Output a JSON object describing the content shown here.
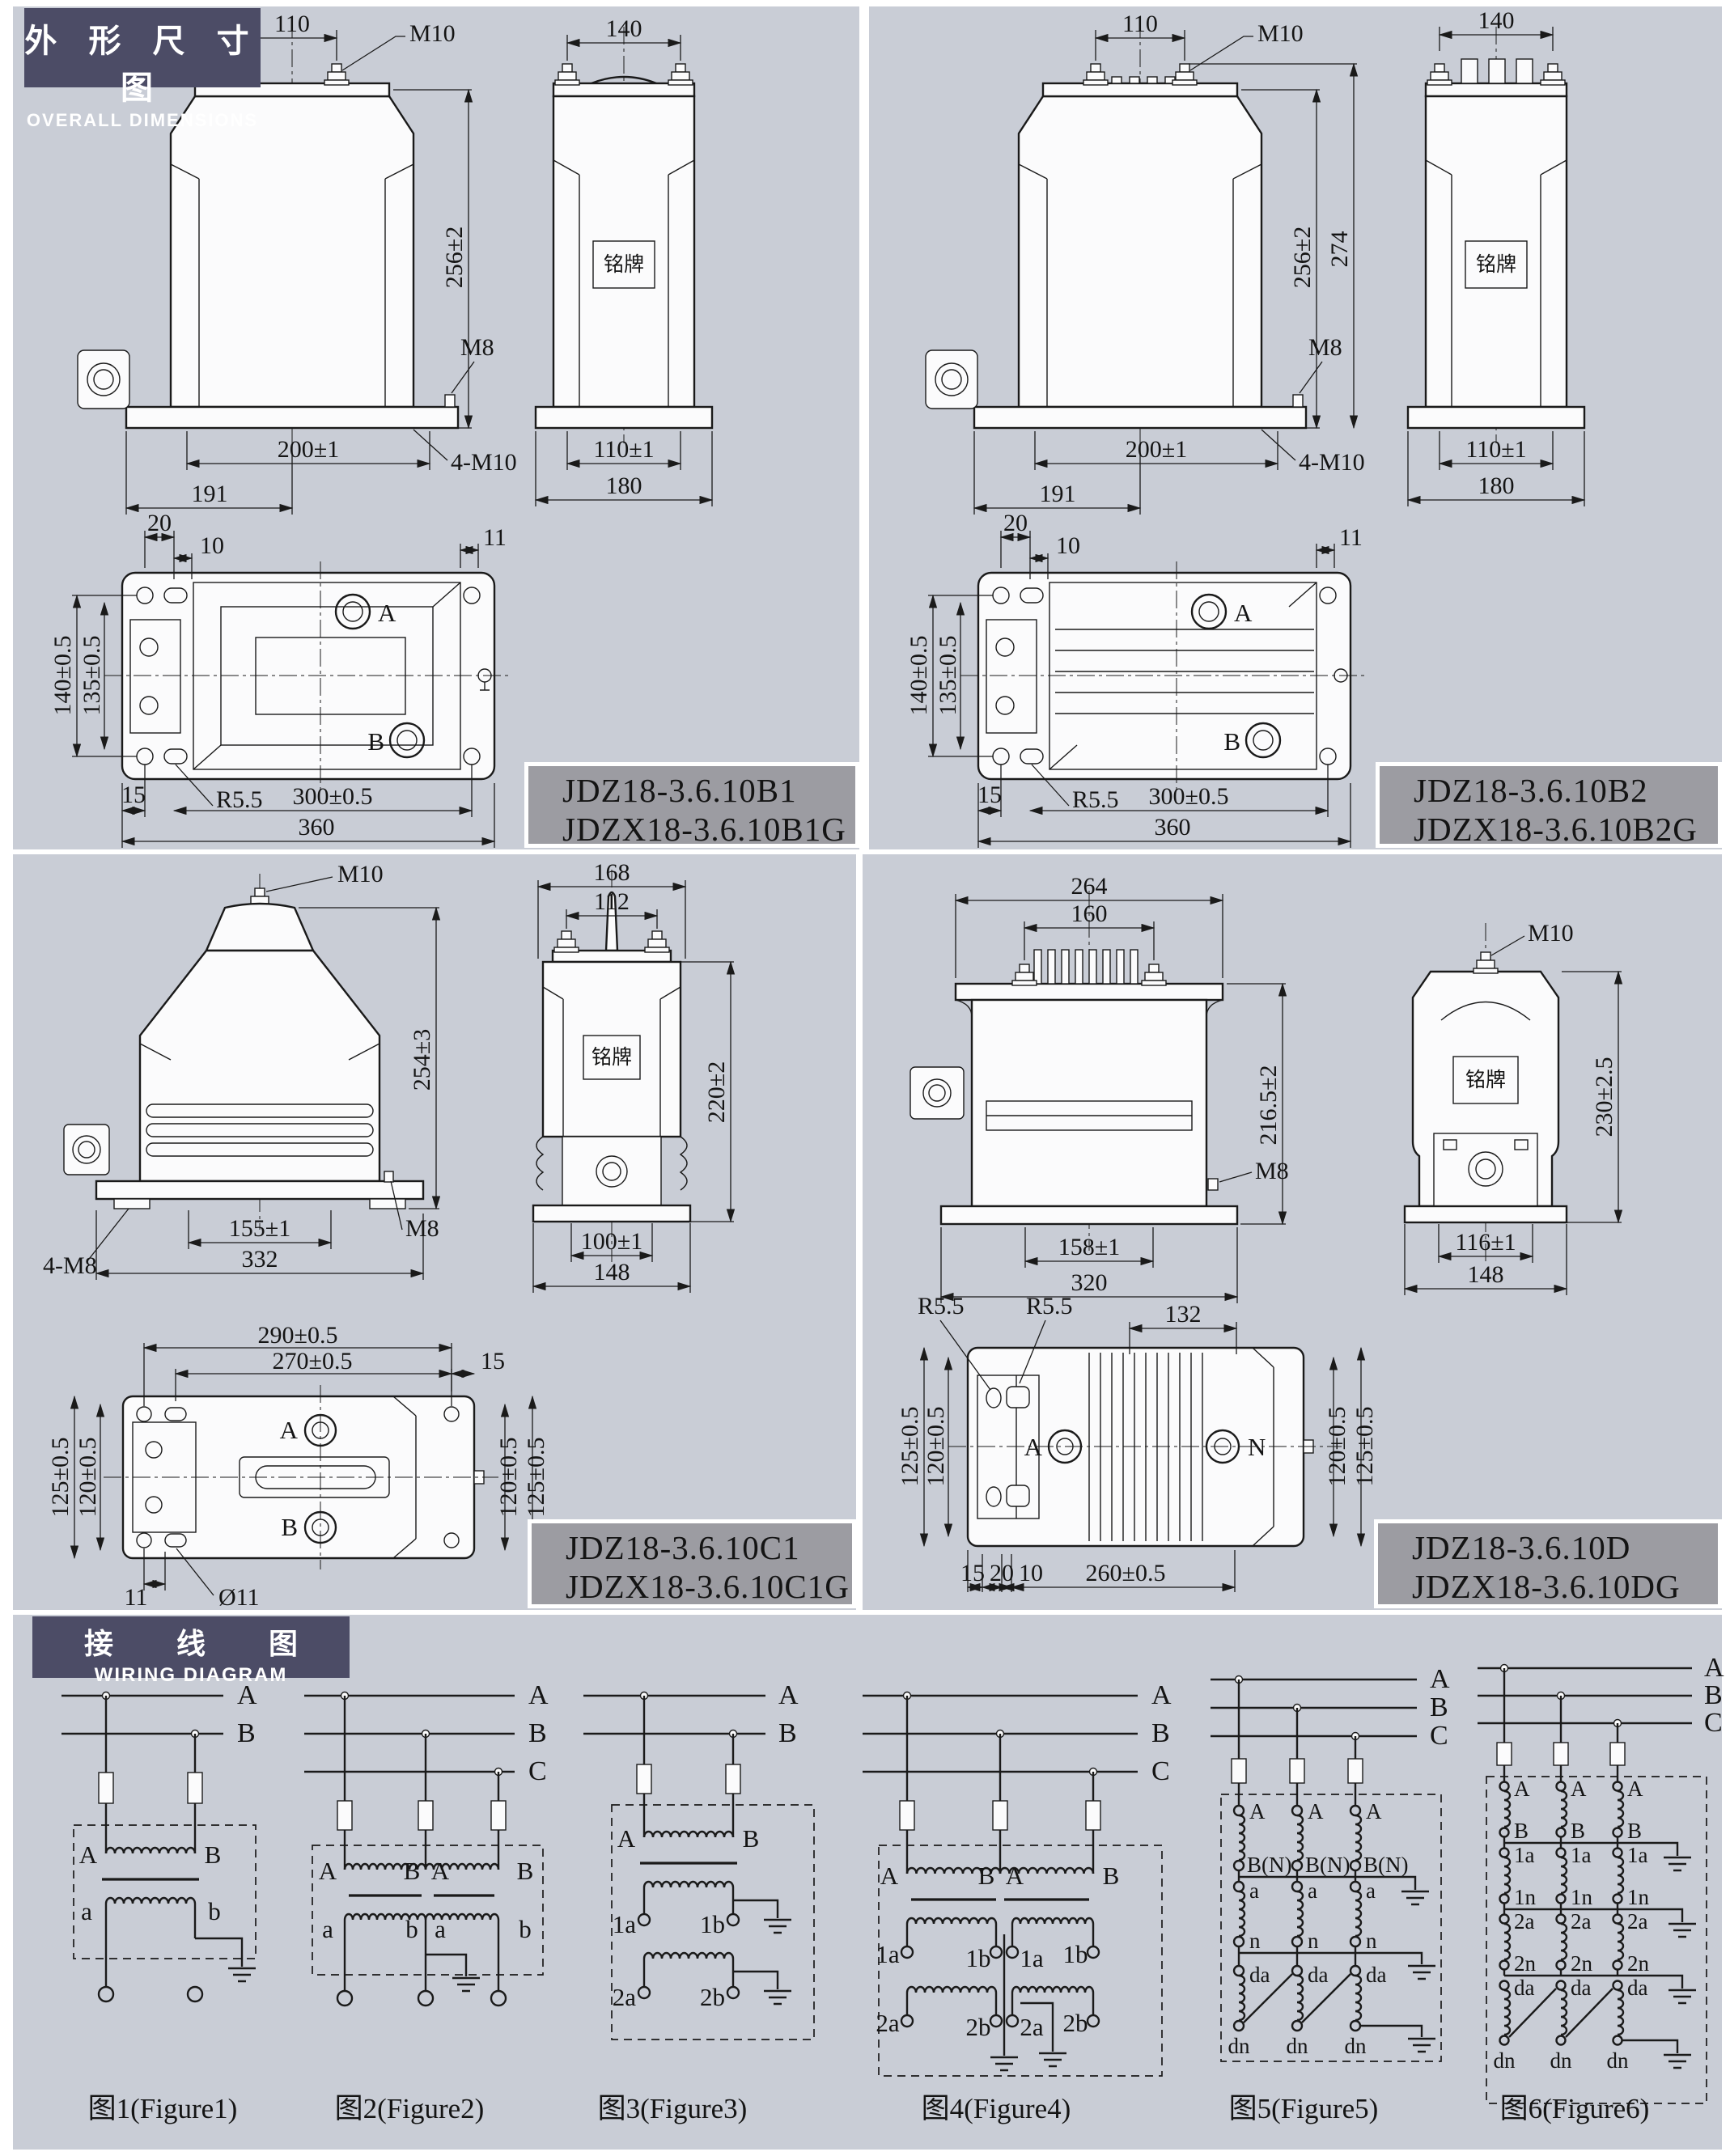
{
  "page": {
    "bg": "#c9cdd6",
    "white": "#ffffff",
    "line": "#1a1a1a",
    "header_bg": "#4c4c66",
    "model_box_bg": "#9c9ca2"
  },
  "headers": {
    "dimensions": {
      "zh": "外 形 尺 寸 图",
      "en": "OVERALL DIMENSIONS"
    },
    "wiring": {
      "zh": "接 线 图",
      "en": "WIRING DIAGRAM"
    }
  },
  "panels": [
    {
      "models": [
        "JDZ18-3.6.10B1",
        "JDZX18-3.6.10B1G"
      ],
      "front": {
        "w110": "110",
        "m10": "M10",
        "h256": "256±2",
        "m8": "M8",
        "w200": "200±1",
        "m4x10": "4-M10",
        "w191": "191"
      },
      "side": {
        "w140": "140",
        "nameplate": "铭牌",
        "w110": "110±1",
        "w180": "180"
      },
      "plan": {
        "d20": "20",
        "d10": "10",
        "d11": "11",
        "h140": "140±0.5",
        "h135": "135±0.5",
        "a": "A",
        "b": "B",
        "d15": "15",
        "r": "R5.5",
        "w300": "300±0.5",
        "w360": "360"
      }
    },
    {
      "models": [
        "JDZ18-3.6.10B2",
        "JDZX18-3.6.10B2G"
      ],
      "front": {
        "w110": "110",
        "m10": "M10",
        "h256": "256±2",
        "h274": "274",
        "m8": "M8",
        "w200": "200±1",
        "m4x10": "4-M10",
        "w191": "191"
      },
      "side": {
        "w140": "140",
        "nameplate": "铭牌",
        "w110": "110±1",
        "w180": "180"
      },
      "plan": {
        "d20": "20",
        "d10": "10",
        "d11": "11",
        "h140": "140±0.5",
        "h135": "135±0.5",
        "a": "A",
        "b": "B",
        "d15": "15",
        "r": "R5.5",
        "w300": "300±0.5",
        "w360": "360"
      }
    },
    {
      "models": [
        "JDZ18-3.6.10C1",
        "JDZX18-3.6.10C1G"
      ],
      "front": {
        "m10": "M10",
        "h254": "254±3",
        "m4x8": "4-M8",
        "w155": "155±1",
        "w332": "332",
        "m8": "M8"
      },
      "side": {
        "w168": "168",
        "w112": "112",
        "nameplate": "铭牌",
        "h220": "220±2",
        "w100": "100±1",
        "w148": "148"
      },
      "plan": {
        "w290": "290±0.5",
        "w270": "270±0.5",
        "d15": "15",
        "h125l": "125±0.5",
        "h120l": "120±0.5",
        "a": "A",
        "b": "B",
        "h120r": "120±0.5",
        "h125r": "125±0.5",
        "d11": "11",
        "dia11": "Ø11"
      }
    },
    {
      "models": [
        "JDZ18-3.6.10D",
        "JDZX18-3.6.10DG"
      ],
      "front": {
        "w264": "264",
        "w160": "160",
        "h216": "216.5±2",
        "m8": "M8",
        "w158": "158±1",
        "w320": "320"
      },
      "side": {
        "m10": "M10",
        "nameplate": "铭牌",
        "h230": "230±2.5",
        "w116": "116±1",
        "w148": "148"
      },
      "plan": {
        "r1": "R5.5",
        "r2": "R5.5",
        "w132": "132",
        "h125l": "125±0.5",
        "h120l": "120±0.5",
        "a": "A",
        "n": "N",
        "h120r": "120±0.5",
        "h125r": "125±0.5",
        "d15": "15",
        "d20": "20",
        "d10": "10",
        "w260": "260±0.5"
      }
    }
  ],
  "figures": [
    {
      "caption": "图1(Figure1)",
      "buses": [
        "A",
        "B"
      ],
      "prim": [
        "A",
        "B"
      ],
      "sec": [
        "a",
        "b"
      ]
    },
    {
      "caption": "图2(Figure2)",
      "buses": [
        "A",
        "B",
        "C"
      ],
      "prim": [
        "A",
        "B",
        "A",
        "B"
      ],
      "sec": [
        "a",
        "b",
        "a",
        "b"
      ]
    },
    {
      "caption": "图3(Figure3)",
      "buses": [
        "A",
        "B"
      ],
      "prim": [
        "A",
        "B"
      ],
      "sec1": [
        "1a",
        "1b"
      ],
      "sec2": [
        "2a",
        "2b"
      ]
    },
    {
      "caption": "图4(Figure4)",
      "buses": [
        "A",
        "B",
        "C"
      ],
      "prim": [
        "A",
        "B",
        "A",
        "B"
      ],
      "sec1": [
        "1a",
        "1b",
        "1a",
        "1b"
      ],
      "sec2": [
        "2a",
        "2b",
        "2a",
        "2b"
      ]
    },
    {
      "caption": "图5(Figure5)",
      "buses": [
        "A",
        "B",
        "C"
      ],
      "col": [
        "A",
        "B(N)",
        "a",
        "n",
        "da",
        "dn"
      ]
    },
    {
      "caption": "图6(Figure6)",
      "buses": [
        "A",
        "B",
        "C"
      ],
      "col": [
        "A",
        "B",
        "1a",
        "1n",
        "2a",
        "2n",
        "da",
        "dn"
      ]
    }
  ]
}
